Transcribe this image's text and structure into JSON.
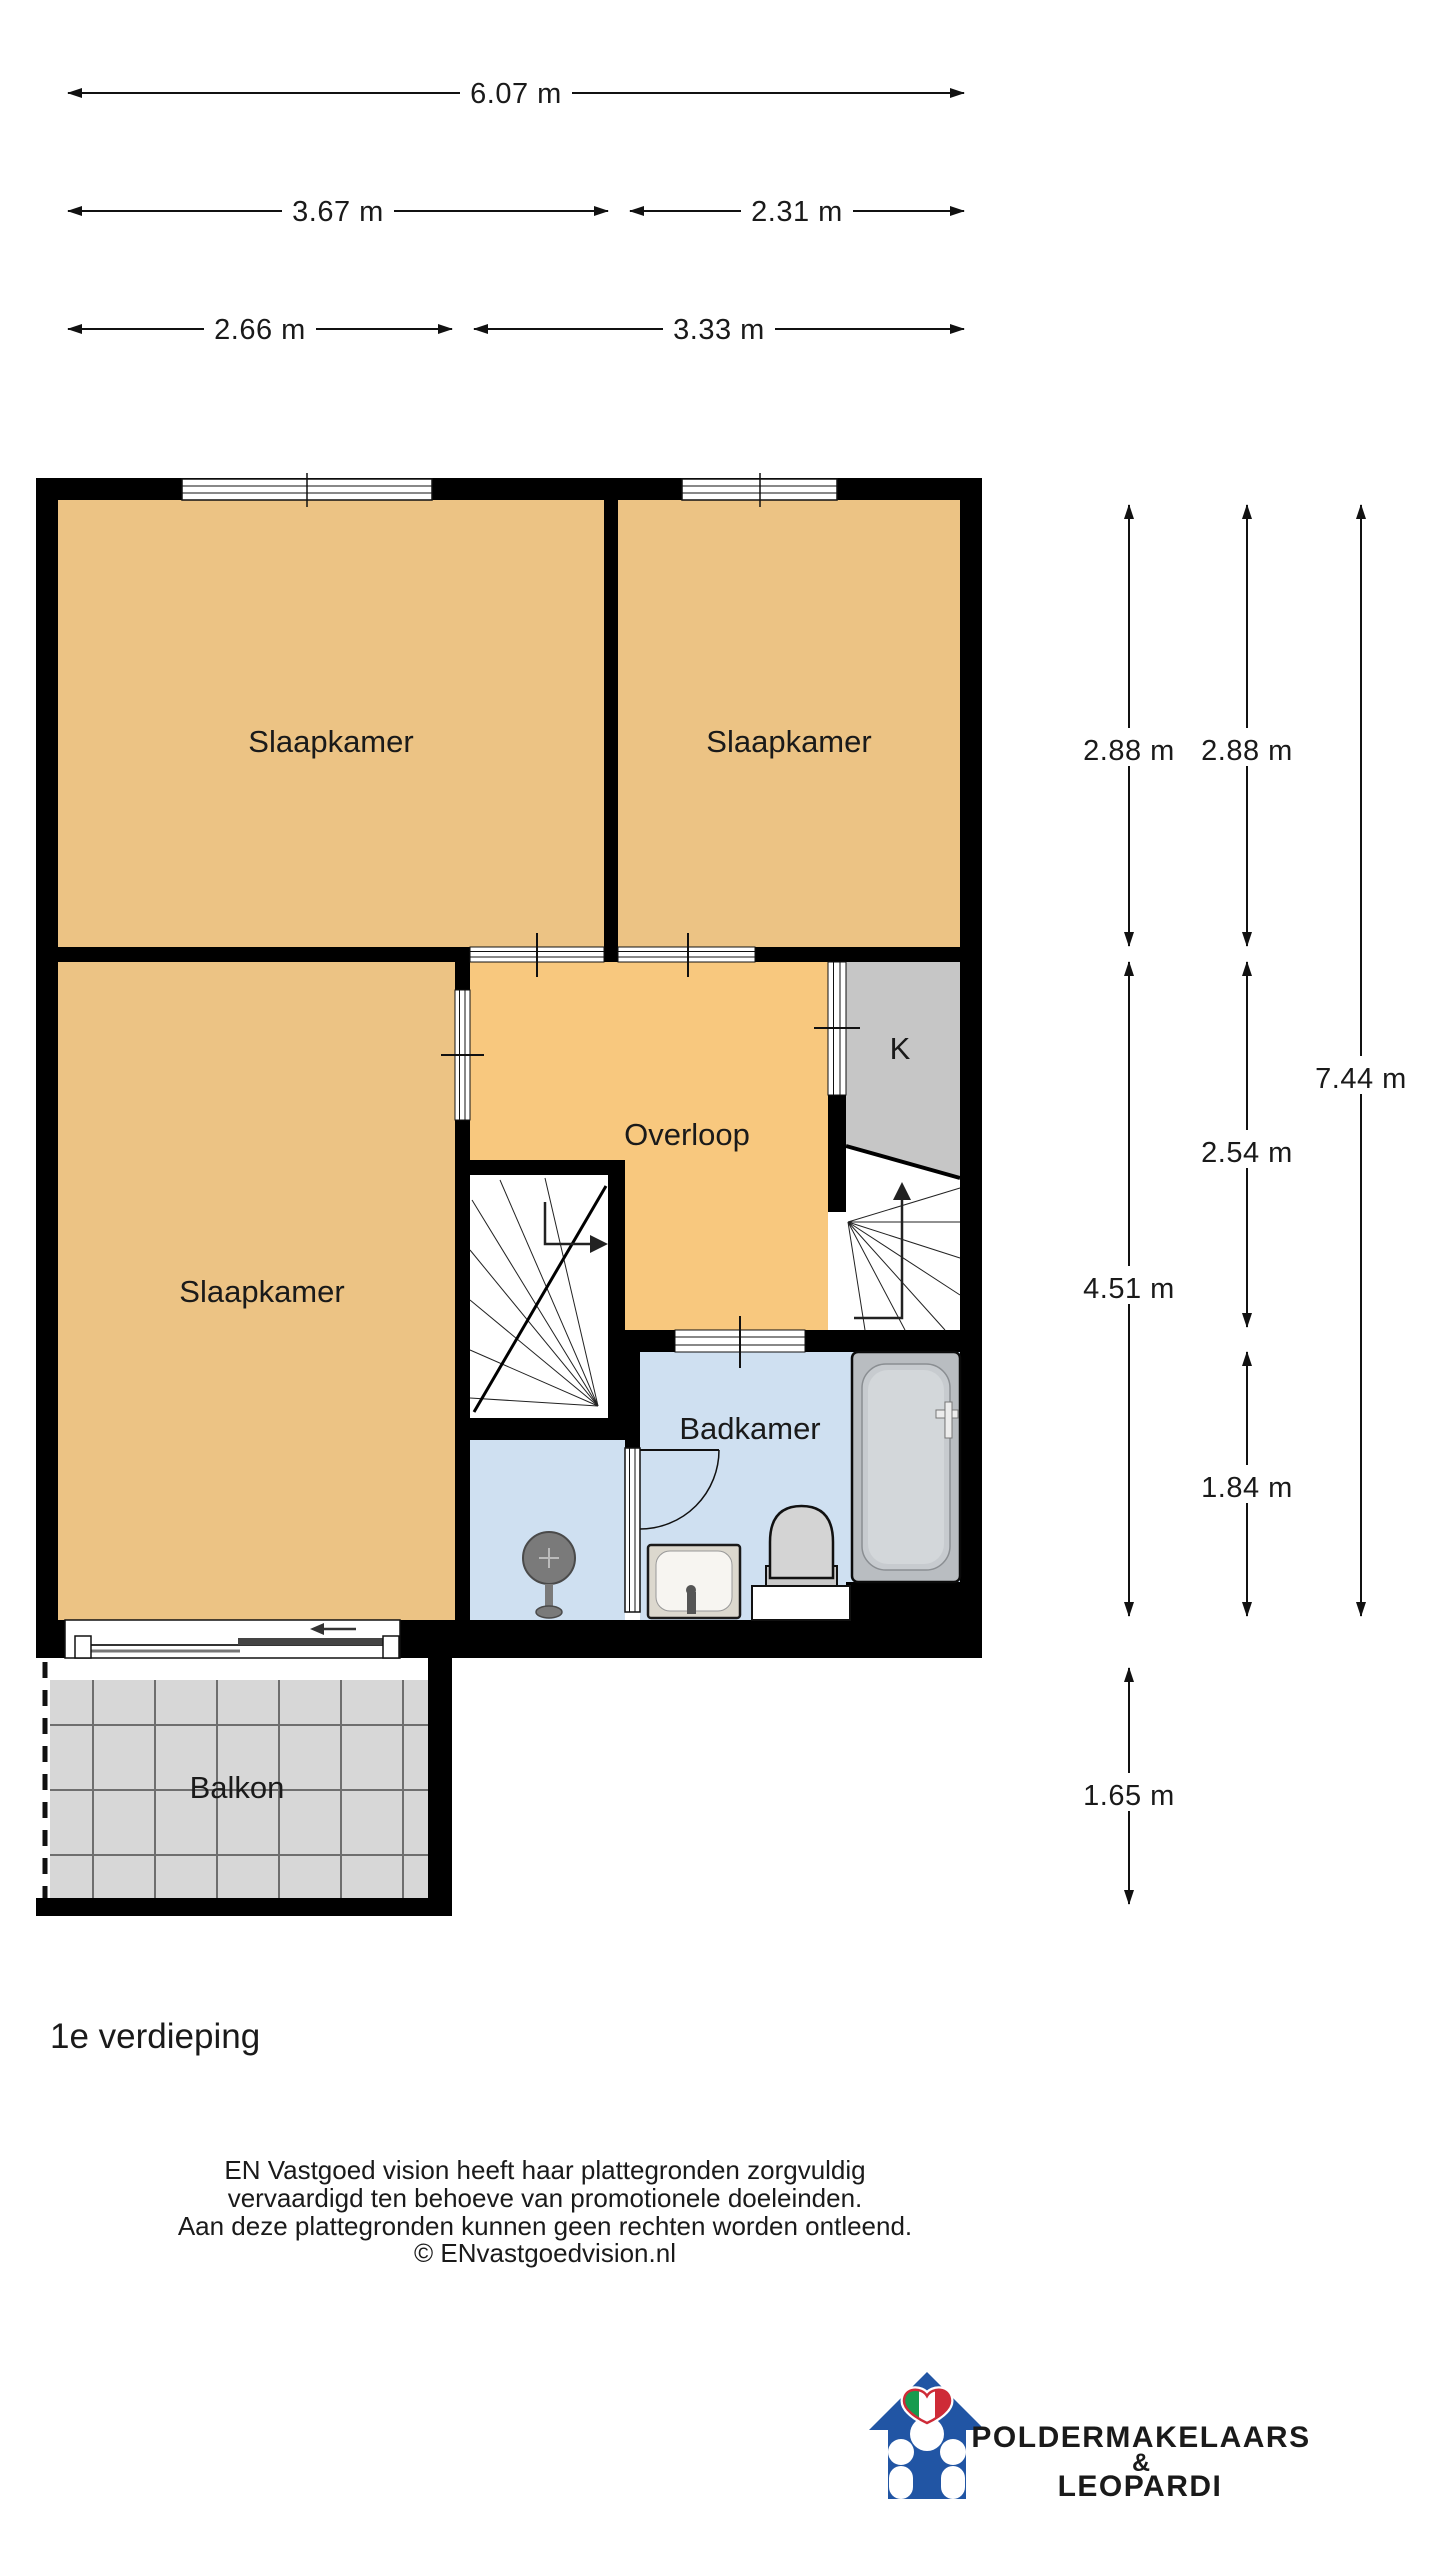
{
  "floor_title": "1e verdieping",
  "rooms": {
    "bedroom_top_left": "Slaapkamer",
    "bedroom_top_right": "Slaapkamer",
    "bedroom_left": "Slaapkamer",
    "landing": "Overloop",
    "closet": "K",
    "bathroom": "Badkamer",
    "balcony": "Balkon"
  },
  "dimensions": {
    "top_total_width": "6.07 m",
    "top_width_left": "3.67 m",
    "top_width_right": "2.31 m",
    "lower_width_left": "2.66 m",
    "lower_width_right": "3.33 m",
    "bedrooms_depth_left": "2.88 m",
    "bedrooms_depth_right": "2.88 m",
    "total_depth": "7.44 m",
    "landing_depth": "2.54 m",
    "bedroom_left_depth": "4.51 m",
    "bathroom_depth": "1.84 m",
    "balcony_depth": "1.65 m"
  },
  "disclaimer": {
    "line1": "EN Vastgoed vision heeft haar plattegronden zorgvuldig",
    "line2": "vervaardigd ten behoeve van promotionele doeleinden.",
    "line3": "Aan deze plattegronden kunnen geen rechten worden ontleend.",
    "line4": "© ENvastgoedvision.nl"
  },
  "logo": {
    "name_top": "POLDERMAKELAARS",
    "ampersand": "&",
    "name_bottom": "LEOPARDI",
    "brand_color": "#1F4E96"
  },
  "colors": {
    "wall": "#000000",
    "bedroom_fill": "#ECC384",
    "landing_fill": "#F8C87E",
    "bathroom_fill": "#CFE0F1",
    "closet_fill": "#C6C6C6",
    "balcony_tile": "#D7D7D7",
    "balcony_grid": "#6E6E6E"
  }
}
